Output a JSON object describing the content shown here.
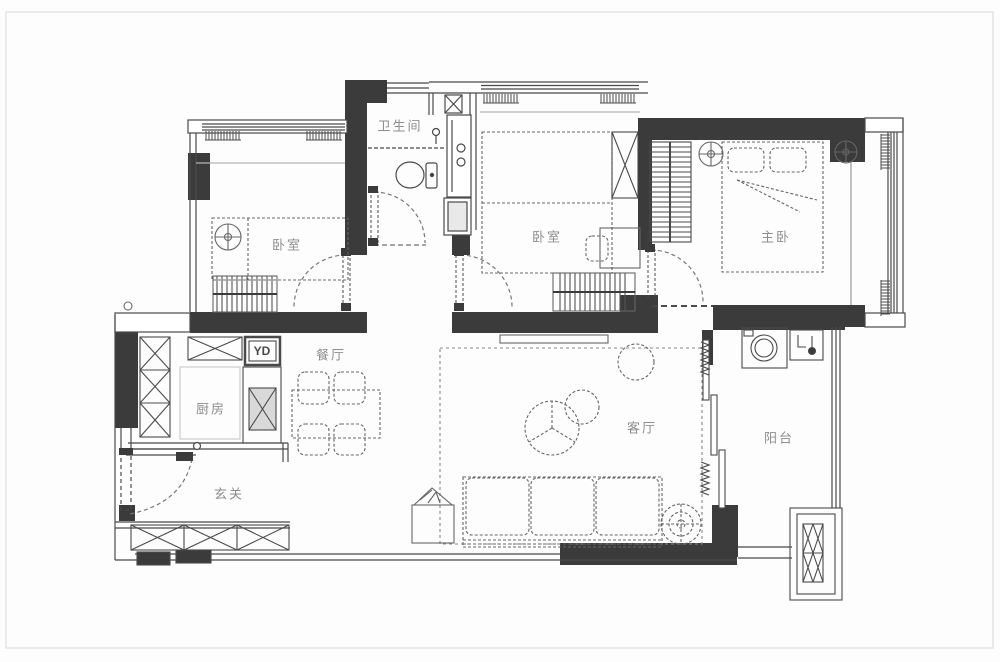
{
  "plan": {
    "type": "apartment-floor-plan",
    "colors": {
      "wall": "#3b3b3b",
      "line_dark": "#4a4a4a",
      "line_mid": "#6a6a6a",
      "line_light": "#9a9a9a",
      "label": "#8d8d8d",
      "background": "#fdfdfd",
      "frame": "#e0e0e0"
    },
    "rooms": {
      "bedroom1": {
        "label": "卧室"
      },
      "bathroom": {
        "label": "卫生间"
      },
      "bedroom2": {
        "label": "卧室"
      },
      "master_bedroom": {
        "label": "主卧"
      },
      "kitchen": {
        "label": "厨房"
      },
      "dining": {
        "label": "餐厅"
      },
      "foyer": {
        "label": "玄关"
      },
      "living": {
        "label": "客厅"
      },
      "balcony": {
        "label": "阳台"
      }
    },
    "annotations": {
      "duct_label": "YD"
    }
  }
}
